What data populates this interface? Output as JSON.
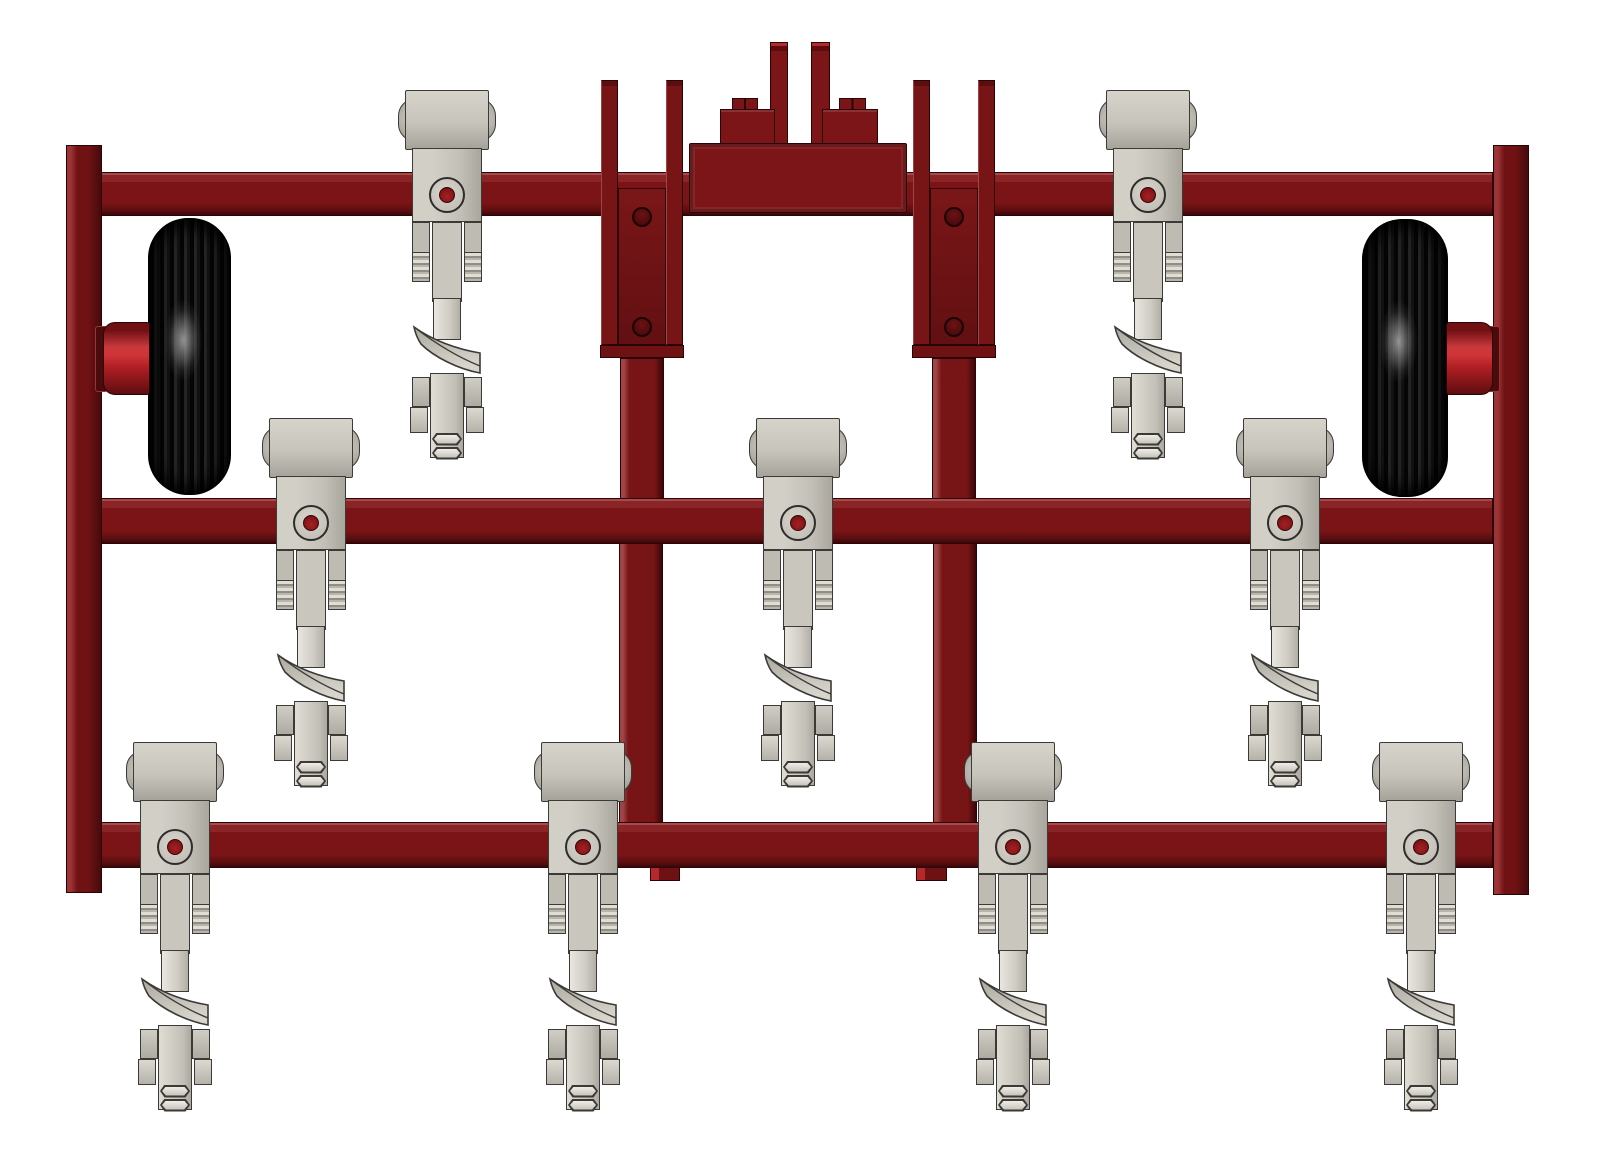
{
  "scene": {
    "description": "3D CAD render, front view of a toolbar cultivator implement: dark-red steel frame with three horizontal toolbars, two outer vertical rails, a stepped three-point hitch tower at top center, two black ribbed gauge wheels with bright red hubs, and nine spring-clamped cultivator shank assemblies with left-pointing sweep blades",
    "canvas": {
      "width": 1600,
      "height": 1165,
      "background": "#ffffff"
    },
    "colors": {
      "frame_face": "#7A1416",
      "frame_face_upper": "#8A2426",
      "frame_top_edge": "#A84A4C",
      "frame_dark_edge": "#3A0708",
      "frame_outline": "#2B0506",
      "rail_light": "#9B3436",
      "rail_face": "#701214",
      "rail_dark": "#460A0B",
      "plate_face_top": "#7A1618",
      "plate_face_bottom": "#621012",
      "post_edge": "#A04547",
      "post_face": "#771416",
      "tab_bright": "#B5282C",
      "tab_dark": "#6E1113",
      "tower_face": "#7C1517",
      "hub_dark_top": "#701013",
      "hub_bright": "#C9393D",
      "hub_mid": "#B01F24",
      "hub_dark_bottom": "#5E0D0F",
      "hole_red": "#8E191C",
      "hole_dark": "#4A0B0D",
      "steel_base": "#C7C4BC",
      "steel_light": "#E5E3DC",
      "steel_mid": "#B5B2AA",
      "steel_dark": "#97948C",
      "steel_outline": "#3B3A36",
      "tire_base": "#121212",
      "tire_rib_dark": "#050505",
      "tire_rib_light": "#242424",
      "tire_highlight": "rgba(170,170,170,0.85)"
    },
    "frame": {
      "rails": [
        {
          "id": "left",
          "x": 66,
          "y": 145,
          "w": 36,
          "h": 748
        },
        {
          "id": "right",
          "x": 1493,
          "y": 145,
          "w": 36,
          "h": 750
        }
      ],
      "bars": [
        {
          "id": "top",
          "x": 101,
          "y": 172,
          "w": 1392,
          "h": 44
        },
        {
          "id": "middle",
          "x": 101,
          "y": 498,
          "w": 1392,
          "h": 46
        },
        {
          "id": "bottom",
          "x": 101,
          "y": 822,
          "w": 1392,
          "h": 46
        }
      ],
      "axle_notches": [
        {
          "id": "left",
          "x": 95,
          "y": 326,
          "w": 13,
          "h": 66
        },
        {
          "id": "right",
          "x": 1487,
          "y": 326,
          "w": 13,
          "h": 66
        }
      ],
      "upper_brackets": [
        {
          "id": "left",
          "cx": 642
        },
        {
          "id": "right",
          "cx": 954
        }
      ],
      "upper_bracket_geometry": {
        "strip_top": 80,
        "strip_h": 265,
        "strip_w": 17,
        "strip_inner_offset": 24,
        "plate_y": 188,
        "plate_h": 157,
        "plate_half_w": 24,
        "hole_cys": [
          217,
          327
        ],
        "hole_r": 10,
        "lip_y": 345,
        "lip_h": 13,
        "lip_half_w": 42,
        "post_y": 358,
        "post_h": 142,
        "post_half_w": 22
      },
      "lower_posts": [
        {
          "id": "left",
          "cx": 641
        },
        {
          "id": "right",
          "cx": 955
        }
      ],
      "lower_post_geometry": {
        "y": 540,
        "h": 300,
        "half_w": 22
      },
      "under_tabs": [
        {
          "id": "left",
          "x": 650,
          "w": 30
        },
        {
          "id": "right",
          "x": 916,
          "w": 31
        }
      ],
      "under_tab_geometry": {
        "y": 867,
        "h": 14
      },
      "hitch_tower": {
        "block": {
          "x": 689,
          "y": 143,
          "w": 218,
          "h": 70
        },
        "step_y": 109,
        "step_h": 36,
        "steps": [
          {
            "x": 720,
            "w": 55
          },
          {
            "x": 822,
            "w": 56
          }
        ],
        "tab_y": 98,
        "tab_h": 13,
        "tabs": [
          {
            "x": 732,
            "w": 26
          },
          {
            "x": 839,
            "w": 27
          }
        ],
        "prong_y": 42,
        "prong_h": 103,
        "prongs": [
          {
            "x": 770,
            "w": 18
          },
          {
            "x": 811,
            "w": 19
          }
        ]
      }
    },
    "wheels": [
      {
        "id": "left",
        "tire": {
          "x": 148,
          "y": 218,
          "w": 83,
          "h": 277
        },
        "hub": {
          "x": 103,
          "y": 322,
          "w": 47,
          "h": 73,
          "cap_side": "left"
        }
      },
      {
        "id": "right",
        "tire": {
          "x": 1362,
          "y": 219,
          "w": 86,
          "h": 278
        },
        "hub": {
          "x": 1446,
          "y": 322,
          "w": 47,
          "h": 73,
          "cap_side": "right"
        }
      }
    ],
    "shanks": {
      "rows": [
        {
          "id": "top",
          "y0": 90,
          "centers": [
            447,
            1148
          ]
        },
        {
          "id": "middle",
          "y0": 418,
          "centers": [
            311,
            798,
            1285
          ]
        },
        {
          "id": "bottom",
          "y0": 742,
          "centers": [
            175,
            583,
            1013,
            1421
          ]
        }
      ],
      "geometry": {
        "bulge": {
          "dx": 49,
          "y": 8,
          "h": 44,
          "r": 18
        },
        "block": {
          "dx": 42,
          "y": 0,
          "h": 60
        },
        "plate": {
          "dx": 35,
          "y": 58,
          "h": 74
        },
        "boss": {
          "cy": 105,
          "r_outer": 18,
          "r_inner": 8
        },
        "channel": {
          "x1": 17,
          "x2": 35,
          "y": 132,
          "h": 60
        },
        "ridges": {
          "y": 162,
          "h": 30
        },
        "strip": {
          "dx": 15,
          "y": 132,
          "h": 80
        },
        "neck": {
          "dx": 14,
          "y": 208,
          "h": 42
        },
        "sweep": {
          "dx": 35,
          "y": 235,
          "h": 50
        },
        "clamp_row1": {
          "x1": 17,
          "x2": 35,
          "y": 287,
          "h": 30
        },
        "clamp_row2": {
          "x1": 19,
          "x2": 37,
          "y": 317,
          "h": 26
        },
        "center_plate": {
          "dx": 17,
          "y": 283,
          "h": 85
        },
        "nuts": {
          "cys": [
            349,
            363
          ],
          "w": 30,
          "h": 13
        }
      }
    }
  }
}
